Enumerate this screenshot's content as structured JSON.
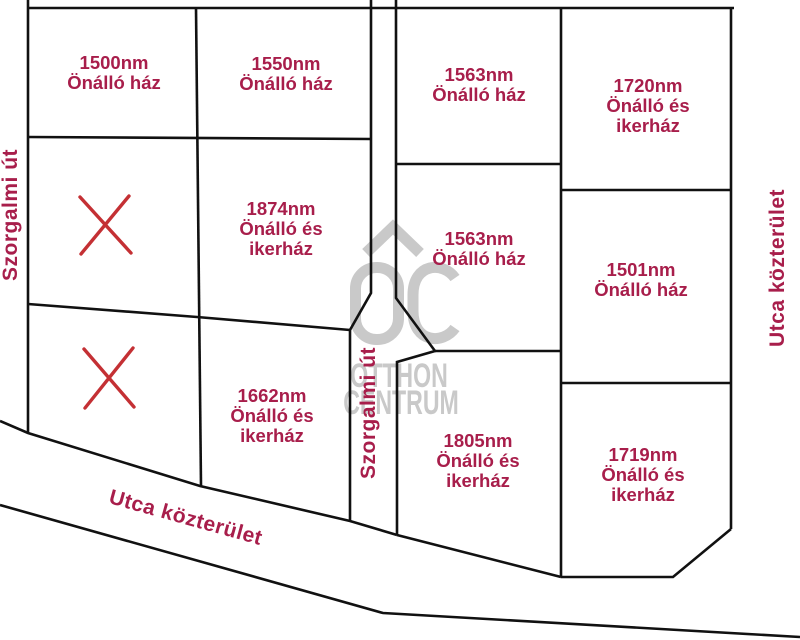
{
  "map": {
    "parcels": [
      {
        "area": "1500nm",
        "l2": "Önálló ház"
      },
      {
        "area": "1550nm",
        "l2": "Önálló ház"
      },
      {
        "area": "1563nm",
        "l2": "Önálló ház"
      },
      {
        "area": "1720nm",
        "l2": "Önálló és",
        "l3": "ikerház"
      },
      {
        "area": "1874nm",
        "l2": "Önálló és",
        "l3": "ikerház"
      },
      {
        "area": "1563nm",
        "l2": "Önálló ház"
      },
      {
        "area": "1501nm",
        "l2": "Önálló ház"
      },
      {
        "area": "1662nm",
        "l2": "Önálló és",
        "l3": "ikerház"
      },
      {
        "area": "1805nm",
        "l2": "Önálló és",
        "l3": "ikerház"
      },
      {
        "area": "1719nm",
        "l2": "Önálló és",
        "l3": "ikerház"
      }
    ],
    "roads": {
      "left_vertical": "Szorgalmi út",
      "center_vertical": "Szorgalmi út",
      "bottom_diagonal": "Utca közterület",
      "right_vertical": "Utca közterület"
    },
    "x_marker_symbol": "✕",
    "x_marker_count": 2
  },
  "watermark": {
    "logo": "OC",
    "line1": "OTTHON",
    "line2": "CENTRUM"
  },
  "colors": {
    "parcel_label": "#A81E4B",
    "x_marker": "#C43034",
    "boundary_line": "#111111",
    "watermark": "#C9C9C9",
    "background": "#FFFFFF"
  }
}
